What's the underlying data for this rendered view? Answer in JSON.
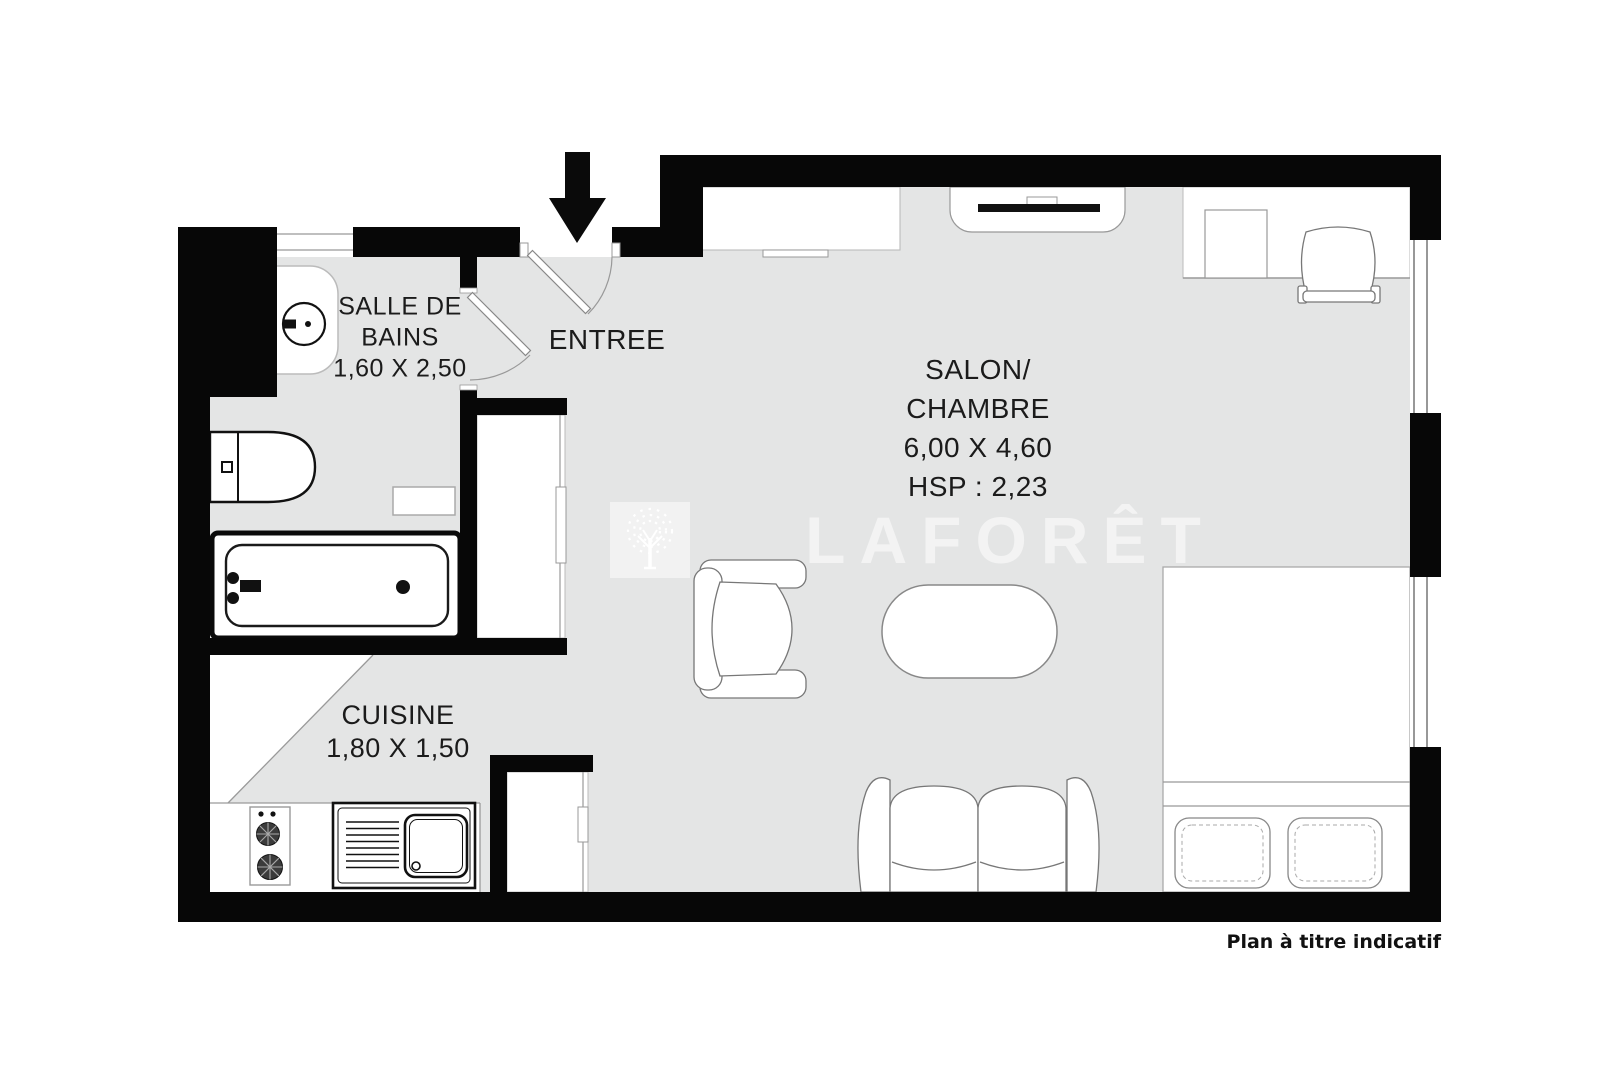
{
  "footer": {
    "note": "Plan à titre indicatif"
  },
  "watermark": {
    "brand": "LAFORÊT",
    "logo": "laforet-tree-logo"
  },
  "rooms": {
    "bathroom": {
      "name_line1": "SALLE DE",
      "name_line2": "BAINS",
      "dims": "1,60 X 2,50"
    },
    "entry": {
      "name": "ENTREE"
    },
    "living": {
      "name_line1": "SALON/",
      "name_line2": "CHAMBRE",
      "dims": "6,00 X 4,60",
      "ceiling": "HSP : 2,23"
    },
    "kitchen": {
      "name": "CUISINE",
      "dims": "1,80 X 1,50"
    }
  },
  "colors": {
    "wall": "#070707",
    "floor": "#e4e5e5",
    "ink": "#1b1b1b",
    "fixture_outline": "#8c8c8c"
  },
  "fixtures": [
    "entrance-arrow",
    "entrance-door",
    "bathroom-door",
    "washbasin",
    "toilet",
    "bathtub",
    "bathroom-shelf",
    "hall-closet",
    "entry-wardrobe",
    "fireplace",
    "desk",
    "desk-chair",
    "window",
    "armchair",
    "coffee-table",
    "sofa",
    "double-bed",
    "pillow",
    "stove",
    "kitchen-sink",
    "refrigerator-closet"
  ]
}
